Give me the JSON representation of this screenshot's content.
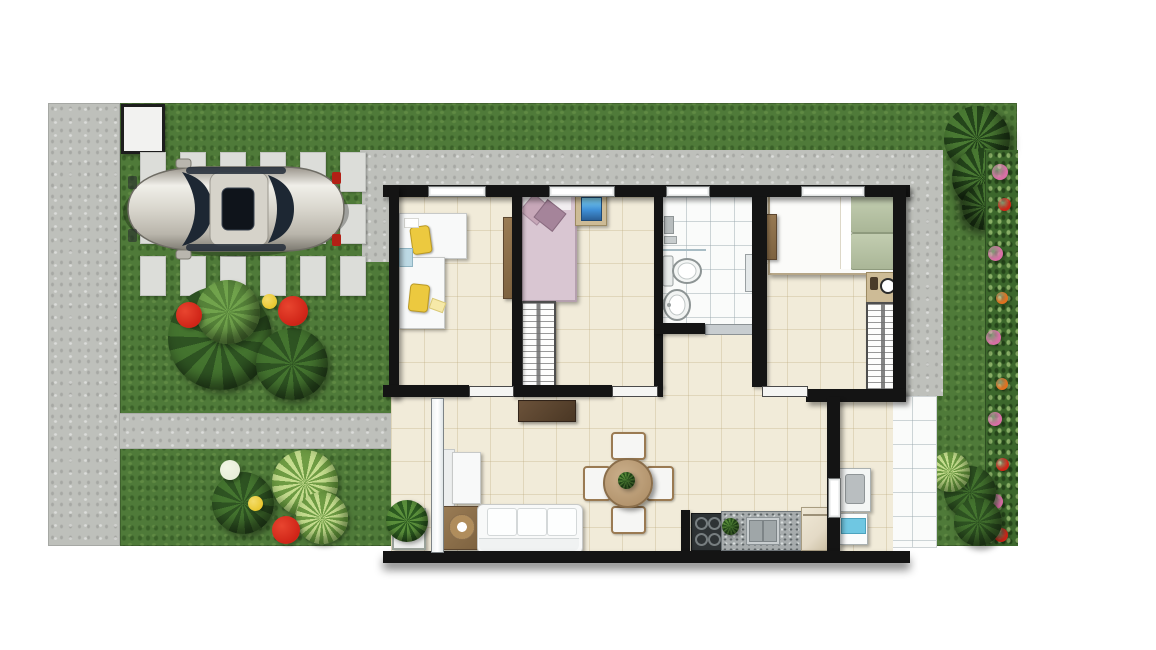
{
  "title": "Top-down furnished floor plan of a two-bedroom house with garden, driveway and parked car",
  "canvas": {
    "width": 1156,
    "height": 650
  },
  "palette": {
    "canvas": "#ffffff",
    "grass": "#4f7a39",
    "bush_dark": "#2e5322",
    "bush_mid": "#44742f",
    "bush_light": "#71a34c",
    "concrete": "#bec0bb",
    "paver": "#dcddd9",
    "wall": "#141414",
    "floor": "#f1ebd9",
    "tile_white": "#fafbfa",
    "flower_red": "#cf2417",
    "flower_pink": "#d86fa5",
    "flower_orange": "#e0711f",
    "flower_yellow": "#e9c72f",
    "flower_white": "#e8eed8",
    "bed2_blanket": "#d9c6d2",
    "bed2_pillow_a": "#c7a7b8",
    "bed2_pillow_b": "#a5849a",
    "bed3_pillow": "#aab697",
    "tv_blue": "#3f8fd6",
    "washer_blue": "#6fc7e2",
    "stove": "#2e3335",
    "fridge": "#e4dac6",
    "car_body": "#d9d6cd",
    "car_glass": "#1d2733",
    "tail_light": "#b32015"
  },
  "scene": {
    "site_areas": [
      "front-sidewalk",
      "entry-gate",
      "lawn",
      "paver-driveway",
      "concrete-walkway",
      "garden-path",
      "service-yard-tiles",
      "flower-border",
      "garden-tree",
      "shrub-clusters"
    ],
    "vehicle": {
      "type": "sedan-car",
      "color": "silver",
      "location": "driveway",
      "facing": "left"
    },
    "rooms": [
      {
        "name": "home-office",
        "furniture": [
          "l-shaped-white-desk",
          "yellow-desk-chair",
          "yellow-desk-chair",
          "open-door-leaf"
        ]
      },
      {
        "name": "bedroom-2",
        "furniture": [
          "single-bed-pink-bedding",
          "nightstand",
          "blue-tv-unit",
          "wardrobe-with-hangers"
        ]
      },
      {
        "name": "bathroom",
        "furniture": [
          "shower-fixtures",
          "glass-partition",
          "toilet",
          "pedestal-sink",
          "door-sill"
        ]
      },
      {
        "name": "master-bedroom",
        "furniture": [
          "double-bed-green-pillows",
          "nightstand-with-lamp",
          "wardrobe-with-hangers",
          "open-door-leaf"
        ]
      },
      {
        "name": "living-dining-room",
        "furniture": [
          "three-seat-sofa",
          "armchair",
          "side-table-with-tray",
          "tv-sideboard",
          "round-dining-table",
          "dining-chair",
          "dining-chair",
          "dining-chair",
          "dining-chair",
          "potted-plant",
          "glass-entry-door"
        ]
      },
      {
        "name": "kitchen",
        "furniture": [
          "four-burner-cooktop",
          "granite-counter-with-sink",
          "counter-plant",
          "refrigerator"
        ]
      },
      {
        "name": "service-laundry-yard",
        "furniture": [
          "laundry-tank",
          "washing-machine"
        ]
      }
    ],
    "windows": [
      "office-window",
      "bedroom2-window",
      "bathroom-window",
      "master-bedroom-window"
    ],
    "doors": [
      "office-door",
      "bedroom2-door",
      "bathroom-door",
      "master-bedroom-door",
      "service-door",
      "porch-glass-door"
    ]
  },
  "driveway": {
    "origin_x": 140,
    "origin_y": 152,
    "cols": 6,
    "rows": 3,
    "paver_w": 24,
    "paver_h": 38,
    "step_x": 40,
    "step_y": 52
  },
  "flower_accents": [
    {
      "y": 14,
      "x": 6,
      "r": 16,
      "color": "flower_pink"
    },
    {
      "y": 48,
      "x": 12,
      "r": 13,
      "color": "flower_red"
    },
    {
      "y": 96,
      "x": 2,
      "r": 15,
      "color": "flower_pink"
    },
    {
      "y": 142,
      "x": 10,
      "r": 12,
      "color": "flower_orange"
    },
    {
      "y": 180,
      "x": 0,
      "r": 15,
      "color": "flower_pink"
    },
    {
      "y": 228,
      "x": 10,
      "r": 12,
      "color": "flower_orange"
    },
    {
      "y": 262,
      "x": 2,
      "r": 14,
      "color": "flower_pink"
    },
    {
      "y": 308,
      "x": 10,
      "r": 13,
      "color": "flower_red"
    },
    {
      "y": 344,
      "x": 2,
      "r": 15,
      "color": "flower_pink"
    },
    {
      "y": 378,
      "x": 8,
      "r": 14,
      "color": "flower_red"
    }
  ]
}
